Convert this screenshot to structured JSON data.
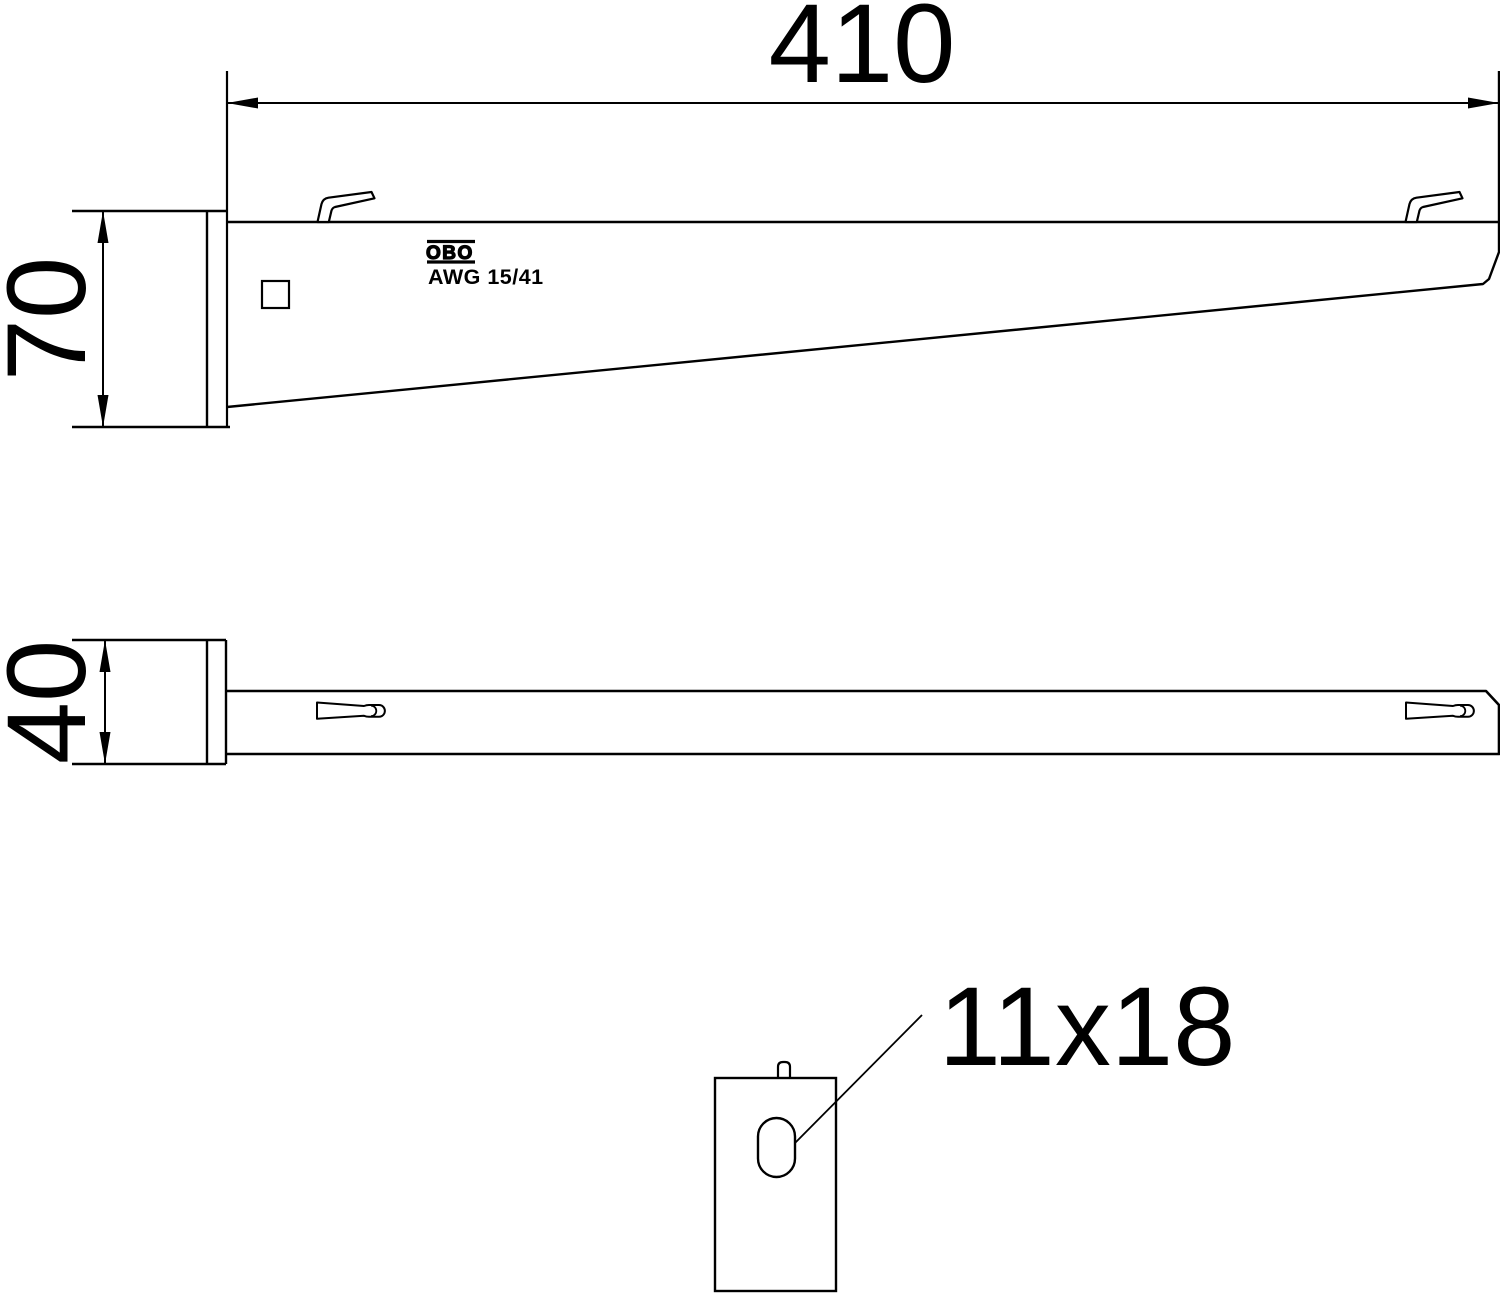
{
  "page": {
    "background": "#ffffff",
    "line_color": "#000000"
  },
  "views": {
    "side_view": {
      "dim_length": "410",
      "dim_height": "70",
      "logo": "OBO",
      "part_label": "AWG 15/41"
    },
    "plan_view": {
      "dim_width": "40"
    },
    "detail_view": {
      "slot_label": "11x18"
    }
  }
}
